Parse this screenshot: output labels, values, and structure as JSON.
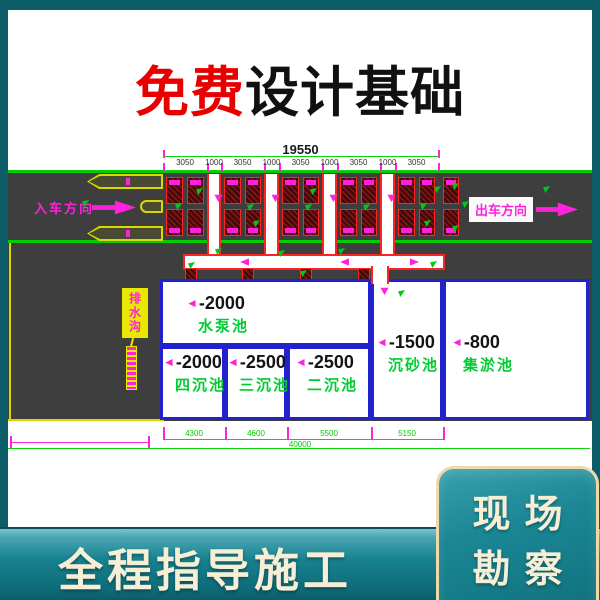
{
  "title": {
    "highlight": "免费",
    "rest": "设计基础"
  },
  "drawing": {
    "total_dim": "19550",
    "segment_dims": [
      "3050",
      "1000",
      "3050",
      "1000",
      "3050",
      "1000",
      "3050",
      "1000",
      "3050"
    ],
    "bottom_dims": [
      "4300",
      "4600",
      "5500",
      "5150"
    ],
    "bottom_total": "40000",
    "entry_label": "入车方向",
    "exit_label": "出车方向",
    "leader_label": "排水沟",
    "slope_note": "⇐8%",
    "pools": [
      {
        "id": "pump",
        "depth": "-2000",
        "name": "水泵池"
      },
      {
        "id": "four",
        "depth": "-2000",
        "name": "四沉池"
      },
      {
        "id": "three",
        "depth": "-2500",
        "name": "三沉池"
      },
      {
        "id": "two",
        "depth": "-2500",
        "name": "二沉池"
      },
      {
        "id": "sand",
        "depth": "-1500",
        "name": "沉砂池"
      },
      {
        "id": "silt",
        "depth": "-800",
        "name": "集淤池"
      }
    ]
  },
  "footer": {
    "banner": "全程指导施工",
    "side_box": [
      "现场",
      "勘察"
    ]
  },
  "colors": {
    "frame_teal": "#0d5d68",
    "band_teal": "#17808e",
    "accent_red": "#e80000",
    "cad_green": "#00cc00",
    "cad_magenta": "#ff22dd",
    "pool_blue": "#2222cc",
    "pad_red": "#ff2222",
    "label_green": "#00cc33",
    "cream_text": "#f7eed6",
    "road_gray": "#3e3e3e"
  }
}
